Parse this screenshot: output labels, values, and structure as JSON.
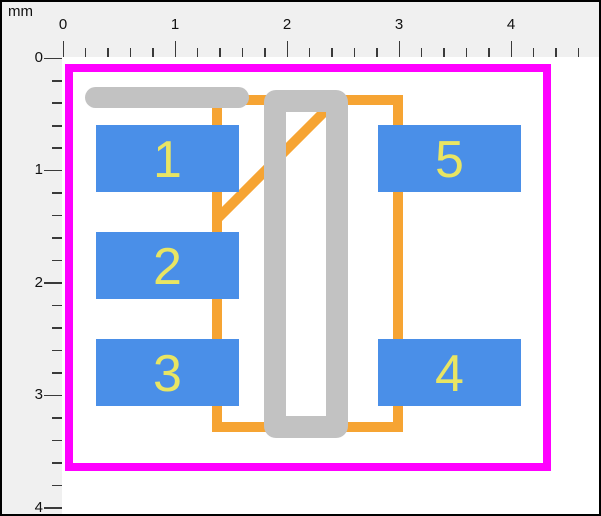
{
  "ruler": {
    "unit": "mm",
    "top_labels": [
      "0",
      "1",
      "2",
      "3",
      "4"
    ],
    "left_labels": [
      "0",
      "1",
      "2",
      "3",
      "4"
    ]
  },
  "pads": [
    {
      "id": "1",
      "label": "1"
    },
    {
      "id": "2",
      "label": "2"
    },
    {
      "id": "3",
      "label": "3"
    },
    {
      "id": "4",
      "label": "4"
    },
    {
      "id": "5",
      "label": "5"
    }
  ],
  "layers": {
    "courtyard": "magenta outline",
    "fabrication": "orange outline with pin-1 diagonal",
    "silkscreen": "gray bar and ring",
    "pads": "blue rectangles with yellow numbers"
  },
  "colors": {
    "courtyard": "#FF00FF",
    "fab_outline": "#F6A433",
    "silkscreen": "#C2C2C2",
    "pad": "#4A8FE8",
    "pad_number": "#E8E563",
    "ruler_bg": "#F0F0F0",
    "canvas_bg": "#FFFFFF",
    "tick": "#3A3A3A",
    "text": "#111111",
    "frame_border": "#000000"
  }
}
